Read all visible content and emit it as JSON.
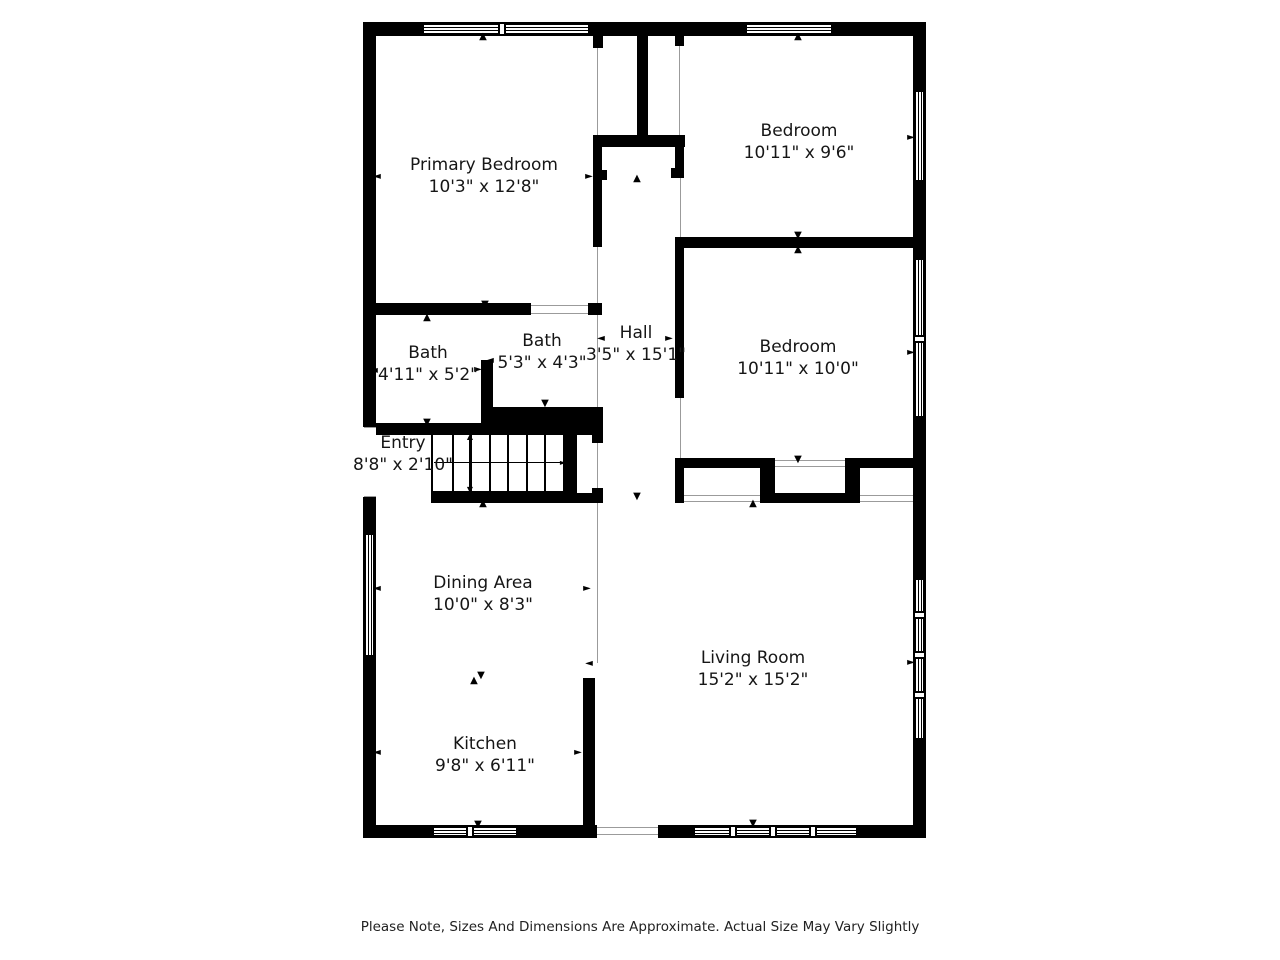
{
  "page": {
    "disclaimer": "Please Note, Sizes And Dimensions Are Approximate. Actual Size May Vary Slightly"
  },
  "floorplan": {
    "wall_color": "#000000",
    "thin_line_color": "#9b9b9b",
    "rooms": [
      {
        "name": "Primary Bedroom",
        "dims": "10'3\" x 12'8\"",
        "cx": 484,
        "cy": 176
      },
      {
        "name": "Bedroom",
        "dims": "10'11\" x 9'6\"",
        "cx": 799,
        "cy": 142
      },
      {
        "name": "Bedroom",
        "dims": "10'11\" x 10'0\"",
        "cx": 798,
        "cy": 358
      },
      {
        "name": "Bath",
        "dims": "4'11\" x 5'2\"",
        "cx": 428,
        "cy": 364
      },
      {
        "name": "Bath",
        "dims": "5'3\" x 4'3\"",
        "cx": 542,
        "cy": 352
      },
      {
        "name": "Hall",
        "dims": "3'5\" x 15'1\"",
        "cx": 636,
        "cy": 344
      },
      {
        "name": "Entry",
        "dims": "8'8\" x 2'10\"",
        "cx": 403,
        "cy": 454
      },
      {
        "name": "Dining Area",
        "dims": "10'0\" x 8'3\"",
        "cx": 483,
        "cy": 594
      },
      {
        "name": "Kitchen",
        "dims": "9'8\" x 6'11\"",
        "cx": 485,
        "cy": 755
      },
      {
        "name": "Living Room",
        "dims": "15'2\" x 15'2\"",
        "cx": 753,
        "cy": 669
      }
    ],
    "walls": [
      [
        363,
        22,
        563,
        14
      ],
      [
        363,
        22,
        13,
        816
      ],
      [
        913,
        22,
        13,
        816
      ],
      [
        363,
        825,
        563,
        13
      ],
      [
        637,
        36,
        11,
        105
      ],
      [
        593,
        36,
        10,
        12
      ],
      [
        675,
        36,
        9,
        10
      ],
      [
        593,
        135,
        92,
        12
      ],
      [
        593,
        147,
        9,
        100
      ],
      [
        602,
        170,
        5,
        10
      ],
      [
        675,
        135,
        9,
        43
      ],
      [
        671,
        168,
        4,
        10
      ],
      [
        675,
        237,
        251,
        11
      ],
      [
        675,
        248,
        9,
        150
      ],
      [
        363,
        303,
        168,
        12
      ],
      [
        588,
        303,
        14,
        12
      ],
      [
        481,
        360,
        12,
        63
      ],
      [
        363,
        423,
        130,
        12
      ],
      [
        481,
        407,
        122,
        28
      ],
      [
        563,
        435,
        14,
        58
      ],
      [
        592,
        435,
        11,
        8
      ],
      [
        592,
        488,
        11,
        15
      ],
      [
        431,
        493,
        172,
        10
      ],
      [
        675,
        458,
        100,
        10
      ],
      [
        845,
        458,
        70,
        10
      ],
      [
        675,
        458,
        9,
        45
      ],
      [
        760,
        458,
        15,
        44
      ],
      [
        845,
        458,
        15,
        45
      ],
      [
        760,
        493,
        100,
        10
      ],
      [
        583,
        678,
        12,
        160
      ]
    ],
    "gaps": [
      [
        363,
        427,
        13,
        70
      ],
      [
        597,
        825,
        61,
        13
      ]
    ],
    "windows": [
      {
        "x": 422,
        "y": 24,
        "w": 168,
        "h": 10,
        "mullions": [
          501
        ]
      },
      {
        "x": 745,
        "y": 24,
        "w": 88,
        "h": 10,
        "mullions": []
      },
      {
        "x": 365,
        "y": 533,
        "w": 9,
        "h": 124,
        "mullions": []
      },
      {
        "x": 915,
        "y": 90,
        "w": 9,
        "h": 92,
        "mullions": []
      },
      {
        "x": 915,
        "y": 258,
        "w": 9,
        "h": 160,
        "mullions": [
          338
        ]
      },
      {
        "x": 915,
        "y": 578,
        "w": 9,
        "h": 162,
        "mullions": [
          614,
          654,
          694
        ]
      },
      {
        "x": 432,
        "y": 827,
        "w": 86,
        "h": 9,
        "mullions": [
          469
        ]
      },
      {
        "x": 693,
        "y": 827,
        "w": 165,
        "h": 9,
        "mullions": [
          732,
          772,
          812
        ]
      }
    ],
    "thin_lines": [
      [
        597,
        48,
        1,
        87
      ],
      [
        679,
        46,
        1,
        89
      ],
      [
        597,
        247,
        1,
        56
      ],
      [
        597,
        315,
        1,
        92
      ],
      [
        680,
        178,
        1,
        59
      ],
      [
        680,
        398,
        1,
        60
      ],
      [
        597,
        443,
        1,
        45
      ],
      [
        597,
        503,
        1,
        160
      ],
      [
        531,
        305,
        57,
        1
      ],
      [
        531,
        313,
        57,
        1
      ],
      [
        775,
        460,
        70,
        1
      ],
      [
        775,
        466,
        70,
        1
      ],
      [
        684,
        495,
        76,
        1
      ],
      [
        684,
        501,
        76,
        1
      ],
      [
        860,
        495,
        53,
        1
      ],
      [
        860,
        501,
        53,
        1
      ],
      [
        597,
        827,
        61,
        1
      ],
      [
        597,
        834,
        61,
        1
      ],
      [
        364,
        427,
        12,
        1
      ],
      [
        364,
        496,
        12,
        1
      ]
    ],
    "stairs": {
      "box": [
        431,
        433,
        134,
        60
      ],
      "treads": 6,
      "hline": [
        434,
        462,
        127
      ],
      "vline": [
        469,
        437,
        53
      ]
    },
    "arrow_glyphs": {
      "up": "▲",
      "down": "▼",
      "left": "◄",
      "right": "►"
    },
    "arrows": [
      [
        483,
        37,
        "up"
      ],
      [
        798,
        37,
        "up"
      ],
      [
        377,
        177,
        "left"
      ],
      [
        589,
        177,
        "right"
      ],
      [
        637,
        179,
        "up"
      ],
      [
        911,
        138,
        "right"
      ],
      [
        798,
        236,
        "down"
      ],
      [
        798,
        250,
        "up"
      ],
      [
        601,
        339,
        "left"
      ],
      [
        669,
        339,
        "right"
      ],
      [
        911,
        353,
        "right"
      ],
      [
        485,
        305,
        "down"
      ],
      [
        427,
        318,
        "up"
      ],
      [
        374,
        371,
        "left"
      ],
      [
        478,
        370,
        "right"
      ],
      [
        490,
        361,
        "left"
      ],
      [
        545,
        404,
        "down"
      ],
      [
        427,
        423,
        "down"
      ],
      [
        798,
        460,
        "down"
      ],
      [
        753,
        504,
        "up"
      ],
      [
        637,
        497,
        "down"
      ],
      [
        483,
        504,
        "up"
      ],
      [
        377,
        589,
        "left"
      ],
      [
        377,
        753,
        "left"
      ],
      [
        587,
        589,
        "right"
      ],
      [
        589,
        664,
        "left"
      ],
      [
        578,
        753,
        "right"
      ],
      [
        911,
        663,
        "right"
      ],
      [
        478,
        825,
        "down"
      ],
      [
        753,
        824,
        "down"
      ],
      [
        368,
        505,
        "up"
      ],
      [
        481,
        676,
        "down"
      ],
      [
        474,
        681,
        "up"
      ]
    ]
  }
}
